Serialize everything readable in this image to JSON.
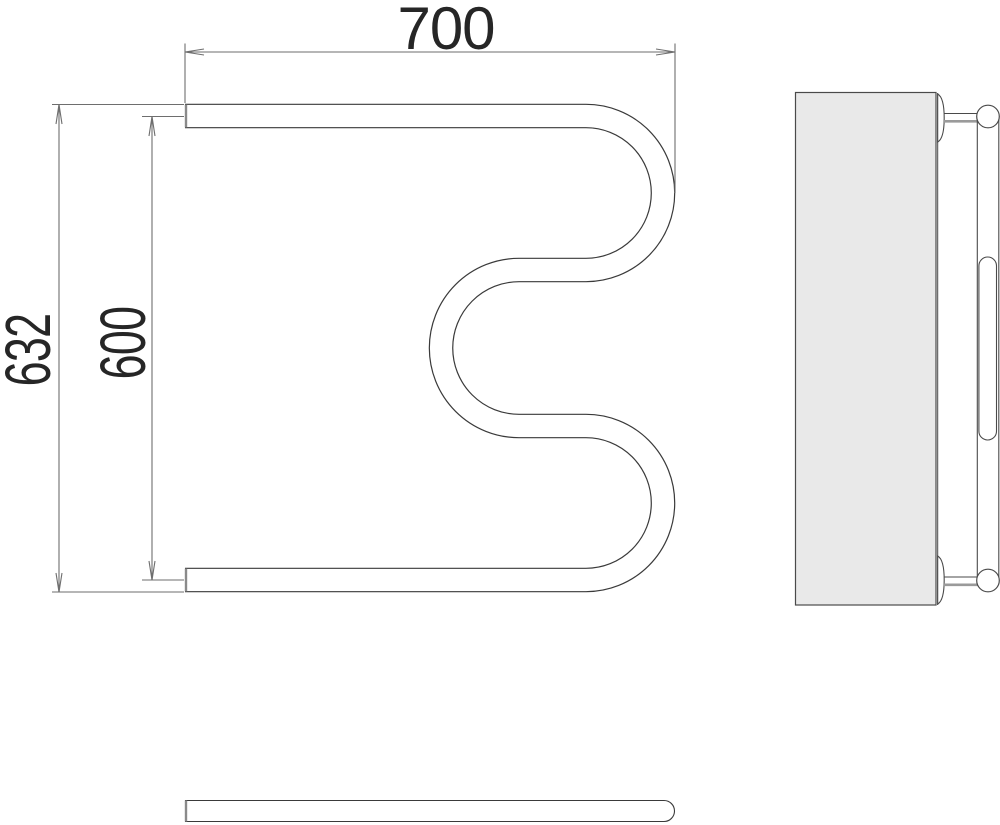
{
  "drawing": {
    "kind": "technical-dimension-drawing",
    "dimensions": {
      "width": "700",
      "height_overall": "632",
      "height_axis": "600"
    },
    "colors": {
      "tube_line": "#3a3a3a",
      "dim_line": "#6e6e6e",
      "text": "#262626",
      "panel_fill": "#e9e9e9",
      "end_cap": "#8a8a8a",
      "background": "#ffffff"
    }
  }
}
